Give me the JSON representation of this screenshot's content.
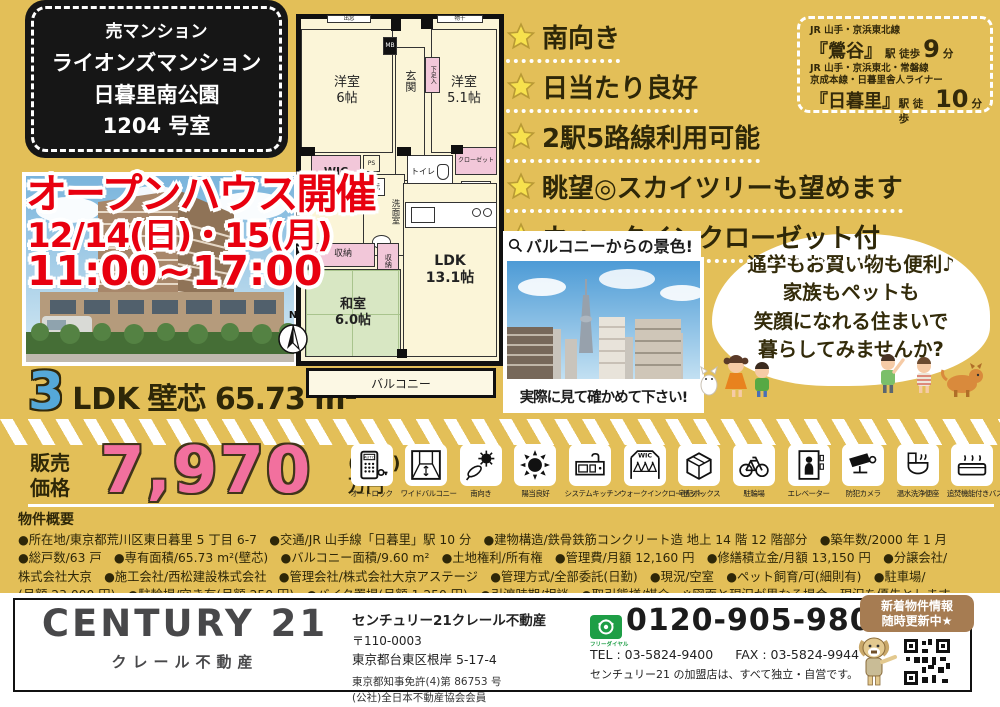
{
  "colors": {
    "background": "#E3BF58",
    "headline_red": "#E8000F",
    "price_pink": "#F2709E",
    "rooms_blue": "#55A8D8",
    "star_yellow": "#F7E14D",
    "badge_brown": "#A67C52",
    "freedial_green": "#1E9E46",
    "tatami_green": "#D8E7C3",
    "closet_pink": "#F2C7D9"
  },
  "property_box": {
    "category": "売マンション",
    "name1": "ライオンズマンション",
    "name2": "日暮里南公園",
    "name3": "1204 号室"
  },
  "open_house": {
    "title": "オープンハウス開催",
    "dates": "12/14(日)・15(月)",
    "time": "11:00~17:00"
  },
  "access": {
    "line1": "JR 山手・京浜東北線",
    "station1": "『鶯谷』",
    "suffix1": "駅 徒歩",
    "minutes1": "9",
    "unit1": "分",
    "line2a": "JR 山手・京浜東北・常磐線",
    "line2b": "京成本線・日暮里舎人ライナー",
    "station2": "『日暮里』",
    "suffix2": "駅 徒歩",
    "minutes2": "10",
    "unit2": "分"
  },
  "features": [
    "南向き",
    "日当たり良好",
    "2駅5路線利用可能",
    "眺望◎スカイツリーも望めます",
    "ウォークインクローゼット付"
  ],
  "view_panel": {
    "caption": "バルコニーからの景色!",
    "note": "実際に見て確かめて下さい!"
  },
  "bubble_lines": [
    "通学もお買い物も便利♪",
    "家族もペットも",
    "笑顔になれる住まいで",
    "暮らしてみませんか?"
  ],
  "floor_plan": {
    "bay_window": "出窓",
    "laundry": "物干",
    "meter_box": "MB",
    "western1": "洋室\n6帖",
    "entrance": "玄関",
    "shoe_box": "下足入",
    "western2": "洋室\n5.1帖",
    "wic": "WIC",
    "ps": "PS",
    "washer": "洗",
    "washroom": "洗面室",
    "toilet": "トイレ",
    "closet": "クローゼット",
    "fridge": "冷",
    "storage1": "収納",
    "storage2": "収納",
    "japanese_room": "和室\n6.0帖",
    "ldk": "LDK\n13.1帖",
    "balcony": "バルコニー",
    "north": "N"
  },
  "size_line": {
    "rooms": "3",
    "type": "LDK",
    "detail": "壁芯 65.73 m²"
  },
  "price": {
    "label1": "販売",
    "label2": "価格",
    "amount": "7,970",
    "tax_note": "(税込)",
    "unit": "万円"
  },
  "amenities": [
    {
      "key": "auto-lock",
      "label": "オートロック"
    },
    {
      "key": "wide-balcony",
      "label": "ワイドバルコニー"
    },
    {
      "key": "south-facing",
      "label": "南向き"
    },
    {
      "key": "sunny",
      "label": "陽当良好"
    },
    {
      "key": "system-kitchen",
      "label": "システムキッチン"
    },
    {
      "key": "walk-in-closet",
      "label": "ウォークインクローゼット"
    },
    {
      "key": "delivery-box",
      "label": "宅配ボックス"
    },
    {
      "key": "bicycle-parking",
      "label": "駐輪場"
    },
    {
      "key": "elevator",
      "label": "エレベーター"
    },
    {
      "key": "security-camera",
      "label": "防犯カメラ"
    },
    {
      "key": "washlet",
      "label": "温水洗浄便座"
    },
    {
      "key": "reheat-bath",
      "label": "追焚機能付きバス"
    }
  ],
  "overview": {
    "title": "物件概要",
    "lines": [
      "●所在地/東京都荒川区東日暮里 5 丁目 6-7　●交通/JR 山手線「日暮里」駅 10 分　●建物構造/鉄骨鉄筋コンクリート造 地上 14 階 12 階部分　●築年数/2000 年 1 月",
      "●総戸数/63 戸　●専有面積/65.73 m²(壁芯)　●バルコニー面積/9.60 m²　●土地権利/所有権　●管理費/月額 12,160 円　●修繕積立金/月額 13,150 円　●分譲会社/",
      "株式会社大京　●施工会社/西松建設株式会社　●管理会社/株式会社大京アステージ　●管理方式/全部委託(日勤)　●現況/空室　●ペット飼育/可(細則有)　●駐車場/",
      "(月額 23,000 円)　●駐輪場/空き有(月額 250 円)　●バイク置場(月額 1,250 円)　●引渡時期/相談　●取引態様/媒介　※図面と現況が異なる場合、現況を優先とします。"
    ]
  },
  "footer": {
    "logo": "CENTURY 21",
    "logo_sub": "クレール不動産",
    "company": "センチュリー21クレール不動産",
    "postal": "〒110-0003",
    "address": "東京都台東区根岸 5-17-4",
    "license1": "東京都知事免許(4)第 86753 号",
    "license2": "(公社)全日本不動産協会会員",
    "freedial_label": "フリーダイヤル",
    "phone": "0120-905-980",
    "tel": "TEL : 03-5824-9400",
    "fax": "FAX : 03-5824-9944",
    "disclaimer": "センチュリー21 の加盟店は、すべて独立・自営です。",
    "badge_line1": "新着物件情報",
    "badge_line2": "随時更新中★"
  }
}
